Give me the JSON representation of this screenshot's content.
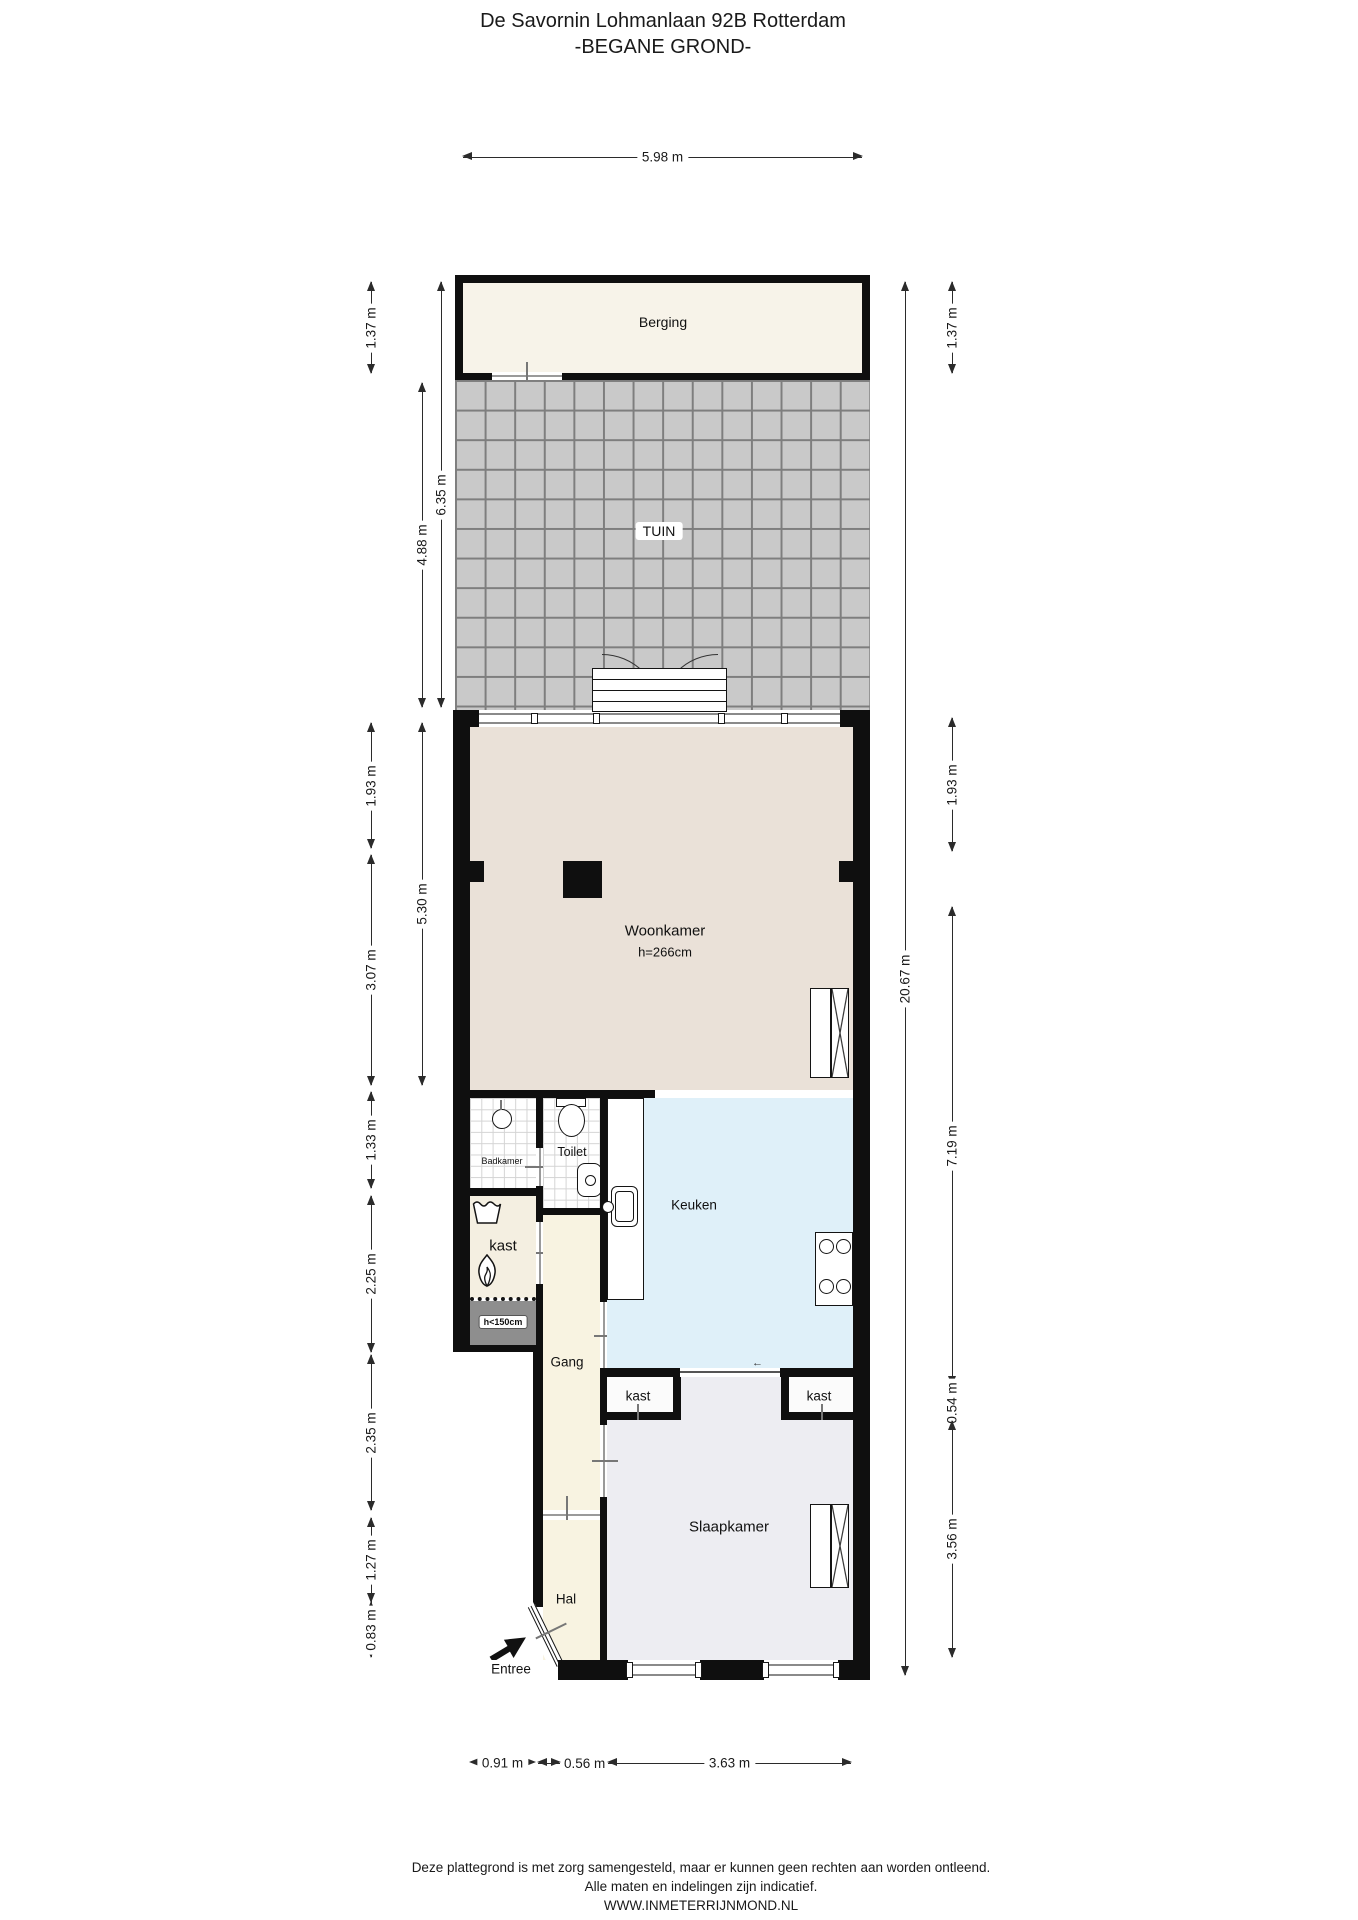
{
  "title": {
    "line1": "De Savornin Lohmanlaan 92B Rotterdam",
    "line2": "-BEGANE GROND-"
  },
  "rooms": {
    "berging": "Berging",
    "tuin": "TUIN",
    "woonkamer": "Woonkamer",
    "woonkamer_ceiling": "h=266cm",
    "badkamer": "Badkamer",
    "toilet": "Toilet",
    "kast": "kast",
    "kast_low_height": "h<150cm",
    "gang": "Gang",
    "keuken": "Keuken",
    "kast_left": "kast",
    "kast_right": "kast",
    "slaapkamer": "Slaapkamer",
    "hal": "Hal",
    "entree": "Entree"
  },
  "dimensions": {
    "top": "5.98 m",
    "left": {
      "berging": "1.37 m",
      "tuin_total": "6.35 m",
      "tuin": "4.88 m",
      "woonkamer_front": "1.93 m",
      "woonkamer": "5.30 m",
      "woonkamer_rear": "3.07 m",
      "badkamer": "1.33 m",
      "kast": "2.25 m",
      "gang": "2.35 m",
      "hal": "1.27 m",
      "entree": "0.83 m"
    },
    "right": {
      "berging": "1.37 m",
      "woonkamer_front": "1.93 m",
      "total": "20.67 m",
      "living": "7.19 m",
      "kast_row": "0.54 m",
      "slaapkamer": "3.56 m"
    },
    "bottom": {
      "left": "0.91 m",
      "middle": "0.56 m",
      "right": "3.63 m"
    }
  },
  "footer": {
    "line1": "Deze plattegrond is met zorg samengesteld, maar er kunnen geen rechten aan worden ontleend.",
    "line2": "Alle maten en indelingen zijn indicatief.",
    "line3": "WWW.INMETERRIJNMOND.NL"
  },
  "colors": {
    "wall": "#0f0f0f",
    "berging_fill": "#f7f3e9",
    "tuin_tile": "#c9c9c9",
    "tuin_grid": "#7e7e7e",
    "woonkamer_fill": "#eae1d8",
    "keuken_fill": "#dff0f9",
    "hall_fill": "#f8f3e1",
    "kast_fill": "#f4efe1",
    "closet_fill": "#fbfbfb",
    "slaapkamer_fill": "#ededf2",
    "low_area_fill": "#8e8e8e"
  }
}
